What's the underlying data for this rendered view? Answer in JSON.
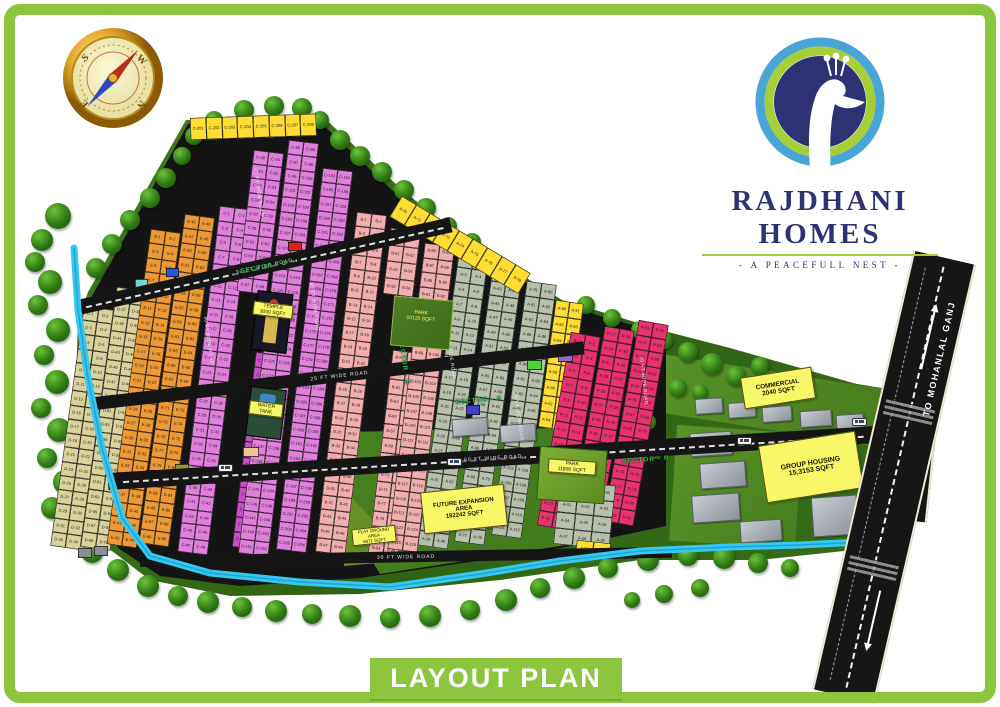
{
  "frame": {
    "border_color": "#8cc63e"
  },
  "banner": {
    "text": "LAYOUT PLAN"
  },
  "logo": {
    "name": "RAJDHANI HOMES",
    "tagline": "- A PEACEFULL NEST -",
    "navy": "#2e3173",
    "green": "#a6ce39",
    "blue": "#49a5d6"
  },
  "compass": {
    "n": "N",
    "e": "E",
    "s": "S",
    "w": "W"
  },
  "map": {
    "palette": {
      "khaki": "#d9d29b",
      "orange": "#ee9933",
      "violet": "#e07fdc",
      "salmon": "#f2aeae",
      "sage": "#b7c0ac",
      "yellow": "#ffdd33",
      "crimson": "#e8326e",
      "magenta": "#c94fc9"
    },
    "highway": {
      "to_top": "TO MOHANLAL GANJ",
      "to_bottom": "TO GOSAIGANJ"
    },
    "areas": {
      "temple": "TEMPLE\n3000 SQFT",
      "water_tank": "WATER\nTANK",
      "park_b": "PARK\n10125 SQFT",
      "park_r": "PARK\n11890 SQFT",
      "commercial": "COMMERCIAL\n2040 SQFT",
      "group_housing": "GROUP HOUSING\n15,3153 SQFT",
      "future": "FUTURE EXPANSION\nAREA\n182242 SQFT",
      "playground": "PLAY GROUND\nAREA\n6871 SQFT"
    },
    "sector_labels": [
      {
        "text": "SECTOR - C",
        "x": 240,
        "y": 268,
        "rot": -10
      },
      {
        "text": "SECTOR - B",
        "x": 404,
        "y": 338,
        "rot": 82
      },
      {
        "text": "SECTOR - A",
        "x": 455,
        "y": 399,
        "rot": -5
      },
      {
        "text": "SECTOR - R",
        "x": 622,
        "y": 458,
        "rot": -4
      }
    ],
    "road_labels_h": [
      {
        "text": "30 FT WIDE ROAD",
        "x": 78,
        "y": 300,
        "len": 382,
        "th": 15,
        "rot": -12.5,
        "dash": true
      },
      {
        "text": "25 FT WIDE ROAD",
        "x": 95,
        "y": 397,
        "len": 492,
        "th": 13,
        "rot": -6.5,
        "dash": false
      },
      {
        "text": "60 FT WIDE ROAD",
        "x": 108,
        "y": 473,
        "len": 772,
        "th": 17,
        "rot": -3.5,
        "dash": true
      },
      {
        "text": "30 FT WIDE ROAD",
        "x": 140,
        "y": 556,
        "len": 532,
        "th": 11,
        "rot": -1,
        "dash": false
      }
    ],
    "road_labels_v": [
      {
        "text": "30 FT WIDE ROAD",
        "x": 208,
        "y": 316,
        "rot": 82
      },
      {
        "text": "30 FT WIDE ROAD",
        "x": 314,
        "y": 282,
        "rot": 82
      },
      {
        "text": "30 FT WIDE ROAD",
        "x": 450,
        "y": 330,
        "rot": 82
      },
      {
        "text": "25 FT WIDE ROAD",
        "x": 518,
        "y": 392,
        "rot": 82
      },
      {
        "text": "40 FT WIDE ROAD",
        "x": 258,
        "y": 168,
        "rot": 82
      },
      {
        "text": "30 FT WIDE ROAD",
        "x": 644,
        "y": 356,
        "rot": 84
      }
    ],
    "blocks": [
      {
        "x": 84,
        "y": 306,
        "w": 30,
        "h": 242,
        "rot": 8,
        "rows": 17,
        "cols": 2,
        "color": "khaki",
        "prefix": "D",
        "start": 1
      },
      {
        "x": 117,
        "y": 287,
        "w": 30,
        "h": 262,
        "rot": 8,
        "rows": 18,
        "cols": 2,
        "color": "khaki",
        "prefix": "D",
        "start": 35
      },
      {
        "x": 151,
        "y": 229,
        "w": 30,
        "h": 318,
        "rot": 8,
        "rows": 22,
        "cols": 2,
        "color": "orange",
        "prefix": "E",
        "start": 1
      },
      {
        "x": 185,
        "y": 214,
        "w": 30,
        "h": 332,
        "rot": 8,
        "rows": 23,
        "cols": 2,
        "color": "orange",
        "prefix": "E",
        "start": 45
      },
      {
        "x": 220,
        "y": 206,
        "w": 30,
        "h": 348,
        "rot": 7,
        "rows": 24,
        "cols": 2,
        "color": "violet",
        "prefix": "C",
        "start": 1
      },
      {
        "x": 254,
        "y": 150,
        "w": 30,
        "h": 142,
        "rot": 7,
        "rows": 10,
        "cols": 2,
        "color": "violet",
        "prefix": "C",
        "start": 49
      },
      {
        "x": 256,
        "y": 352,
        "w": 30,
        "h": 196,
        "rot": 7,
        "rows": 13,
        "cols": 2,
        "color": "magenta",
        "prefix": "C",
        "start": 69
      },
      {
        "x": 289,
        "y": 140,
        "w": 30,
        "h": 416,
        "rot": 7,
        "rows": 29,
        "cols": 2,
        "color": "violet",
        "prefix": "C",
        "start": 95
      },
      {
        "x": 323,
        "y": 168,
        "w": 30,
        "h": 384,
        "rot": 7,
        "rows": 27,
        "cols": 2,
        "color": "violet",
        "prefix": "C",
        "start": 153
      },
      {
        "x": 357,
        "y": 212,
        "w": 30,
        "h": 342,
        "rot": 7,
        "rows": 24,
        "cols": 2,
        "color": "salmon",
        "prefix": "B",
        "start": 1
      },
      {
        "x": 391,
        "y": 228,
        "w": 30,
        "h": 66,
        "rot": 7,
        "rows": 4,
        "cols": 2,
        "color": "salmon",
        "prefix": "B",
        "start": 49
      },
      {
        "x": 393,
        "y": 350,
        "w": 30,
        "h": 206,
        "rot": 7,
        "rows": 14,
        "cols": 2,
        "color": "salmon",
        "prefix": "B",
        "start": 57
      },
      {
        "x": 425,
        "y": 243,
        "w": 30,
        "h": 308,
        "rot": 7,
        "rows": 21,
        "cols": 2,
        "color": "salmon",
        "prefix": "B",
        "start": 85
      },
      {
        "x": 459,
        "y": 252,
        "w": 30,
        "h": 296,
        "rot": 8,
        "rows": 20,
        "cols": 2,
        "color": "sage",
        "prefix": "A",
        "start": 1
      },
      {
        "x": 493,
        "y": 266,
        "w": 30,
        "h": 278,
        "rot": 8,
        "rows": 19,
        "cols": 2,
        "color": "sage",
        "prefix": "A",
        "start": 41
      },
      {
        "x": 527,
        "y": 281,
        "w": 30,
        "h": 256,
        "rot": 8,
        "rows": 17,
        "cols": 2,
        "color": "sage",
        "prefix": "A",
        "start": 79
      },
      {
        "x": 556,
        "y": 300,
        "w": 28,
        "h": 128,
        "rot": 8,
        "rows": 8,
        "cols": 2,
        "color": "yellow",
        "prefix": "A",
        "start": 50
      },
      {
        "x": 571,
        "y": 332,
        "w": 30,
        "h": 196,
        "rot": 10,
        "rows": 13,
        "cols": 2,
        "color": "crimson",
        "prefix": "R",
        "start": 1
      },
      {
        "x": 605,
        "y": 326,
        "w": 30,
        "h": 202,
        "rot": 10,
        "rows": 14,
        "cols": 2,
        "color": "crimson",
        "prefix": "R",
        "start": 27
      },
      {
        "x": 639,
        "y": 320,
        "w": 30,
        "h": 204,
        "rot": 10,
        "rows": 14,
        "cols": 2,
        "color": "crimson",
        "prefix": "R",
        "start": 55
      },
      {
        "x": 190,
        "y": 118,
        "w": 126,
        "h": 22,
        "rot": -2,
        "rows": 1,
        "cols": 8,
        "color": "yellow",
        "prefix": "C",
        "start": 201
      },
      {
        "x": 402,
        "y": 196,
        "w": 150,
        "h": 24,
        "rot": 31,
        "rows": 1,
        "cols": 9,
        "color": "yellow",
        "prefix": "A",
        "start": 70
      },
      {
        "x": 560,
        "y": 480,
        "w": 56,
        "h": 64,
        "rot": 6,
        "rows": 4,
        "cols": 3,
        "color": "sage",
        "prefix": "A",
        "start": 28
      },
      {
        "x": 577,
        "y": 540,
        "w": 34,
        "h": 15,
        "rot": 6,
        "rows": 1,
        "cols": 2,
        "color": "yellow",
        "prefix": "A",
        "start": 52
      }
    ],
    "special_plots": [
      {
        "x": 288,
        "y": 242,
        "w": 14,
        "h": 9,
        "color": "#e02020"
      },
      {
        "x": 166,
        "y": 268,
        "w": 13,
        "h": 9,
        "color": "#2458de"
      },
      {
        "x": 135,
        "y": 279,
        "w": 13,
        "h": 9,
        "color": "#79d2cf"
      },
      {
        "x": 466,
        "y": 405,
        "w": 14,
        "h": 10,
        "color": "#4040c8"
      },
      {
        "x": 527,
        "y": 360,
        "w": 15,
        "h": 10,
        "color": "#46d43c"
      },
      {
        "x": 558,
        "y": 352,
        "w": 15,
        "h": 10,
        "color": "#9668cc"
      },
      {
        "x": 128,
        "y": 472,
        "w": 12,
        "h": 9,
        "color": "#e06428"
      },
      {
        "x": 146,
        "y": 470,
        "w": 12,
        "h": 9,
        "color": "#e06428"
      },
      {
        "x": 175,
        "y": 464,
        "w": 14,
        "h": 9,
        "color": "#9a9a28"
      },
      {
        "x": 78,
        "y": 548,
        "w": 14,
        "h": 10,
        "color": "#8a8f96"
      },
      {
        "x": 94,
        "y": 546,
        "w": 14,
        "h": 10,
        "color": "#8a8f96"
      },
      {
        "x": 243,
        "y": 447,
        "w": 16,
        "h": 10,
        "color": "#f2c49a"
      }
    ],
    "buses": [
      {
        "x": 218,
        "y": 464
      },
      {
        "x": 447,
        "y": 458
      },
      {
        "x": 737,
        "y": 437
      },
      {
        "x": 852,
        "y": 418
      }
    ]
  }
}
